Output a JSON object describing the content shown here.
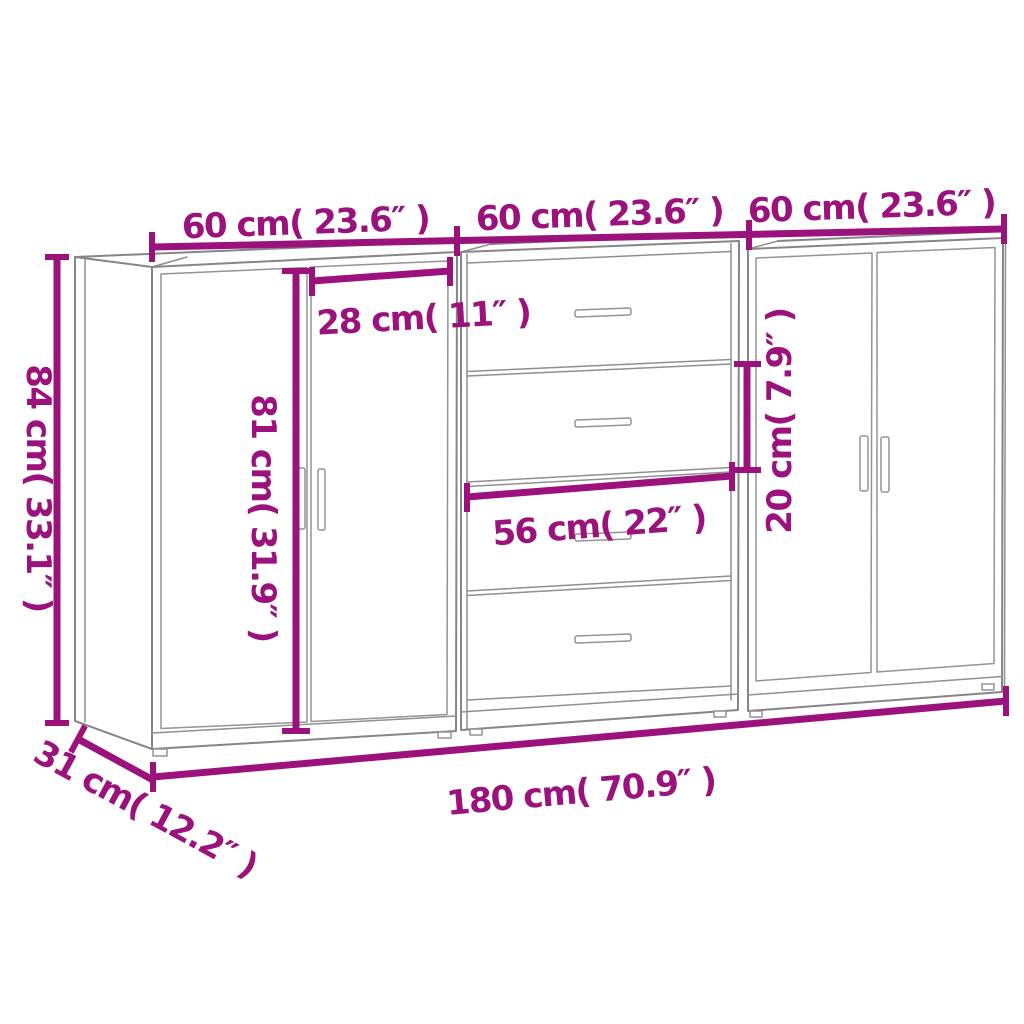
{
  "colors": {
    "accent": "#9B127C",
    "furniture_line": "#868686",
    "background": "#FFFFFF"
  },
  "dimension_labels": {
    "cabinet1_width": "60 cm( 23.6″ )",
    "cabinet2_width": "60 cm( 23.6″ )",
    "cabinet3_width": "60 cm( 23.6″ )",
    "overall_height": "84 cm( 33.1″ )",
    "door_width": "28 cm( 11″ )",
    "door_height": "81 cm( 31.9″ )",
    "drawer_width": "56 cm( 22″ )",
    "drawer_height": "20 cm( 7.9″ )",
    "overall_width": "180 cm( 70.9″ )",
    "depth": "31 cm( 12.2″ )"
  }
}
